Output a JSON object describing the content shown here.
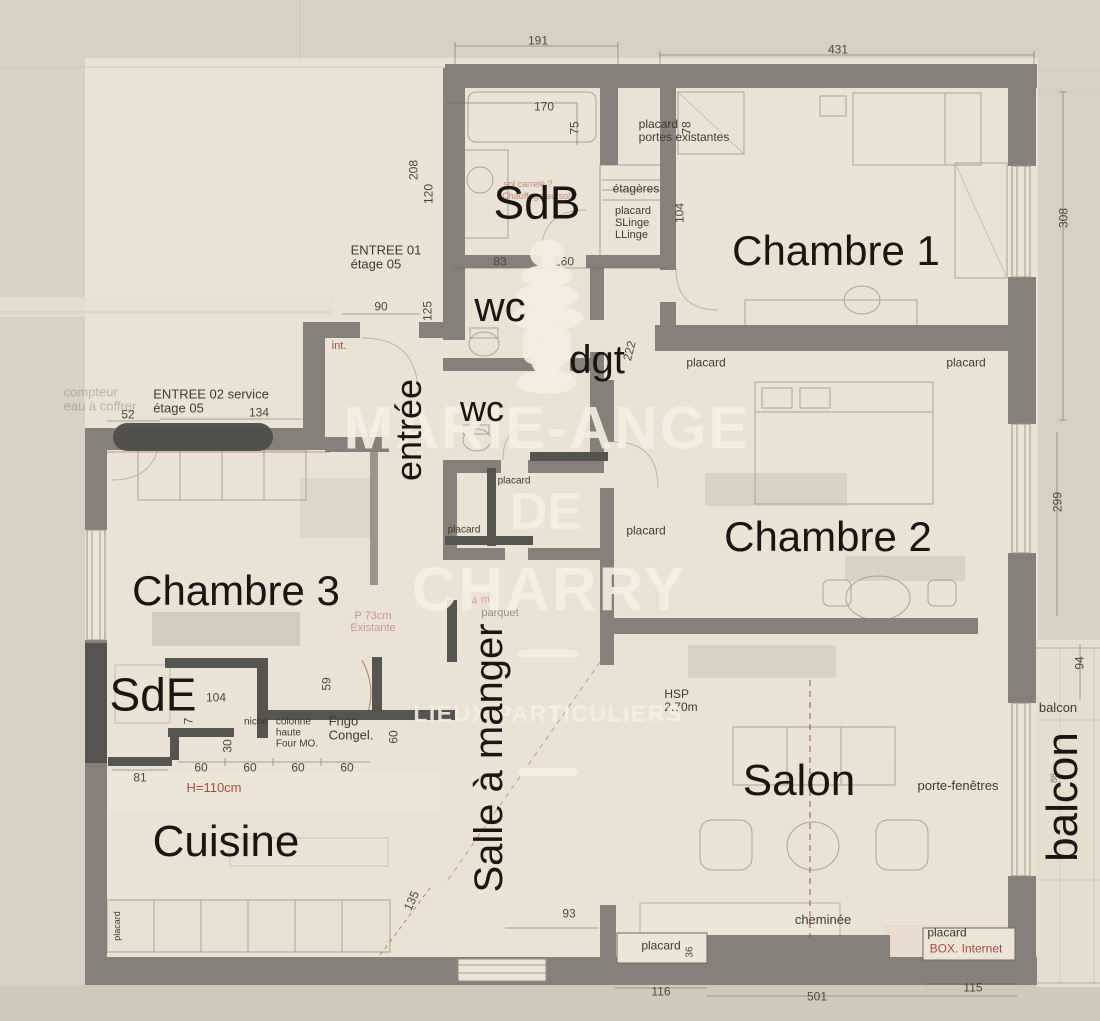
{
  "plan": {
    "background": "#d8d0c3",
    "paper": "#eae3d5",
    "wall_color": "#85817a",
    "marker_color": "#55544f",
    "accent_red": "#a84b3e",
    "watermark_color": "#f2ecdd"
  },
  "watermark": {
    "name": "MARIE-ANGE",
    "de": "DE",
    "surname": "CHARRY",
    "tagline": "LIEUX PARTICULIERS"
  },
  "labels": {
    "rooms": [
      {
        "n": "room-label-sdb",
        "t": "SdB",
        "x": 537,
        "y": 203,
        "s": 46
      },
      {
        "n": "room-label-chambre-1",
        "t": "Chambre 1",
        "x": 836,
        "y": 251,
        "s": 42
      },
      {
        "n": "room-label-chambre-2",
        "t": "Chambre 2",
        "x": 828,
        "y": 537,
        "s": 42
      },
      {
        "n": "room-label-chambre-3",
        "t": "Chambre 3",
        "x": 236,
        "y": 591,
        "s": 42
      },
      {
        "n": "room-label-sde",
        "t": "SdE",
        "x": 153,
        "y": 695,
        "s": 46
      },
      {
        "n": "room-label-cuisine",
        "t": "Cuisine",
        "x": 226,
        "y": 842,
        "s": 44
      },
      {
        "n": "room-label-salon",
        "t": "Salon",
        "x": 799,
        "y": 781,
        "s": 44
      },
      {
        "n": "room-label-wc-1",
        "t": "wc",
        "x": 500,
        "y": 307,
        "s": 42
      },
      {
        "n": "room-label-wc-2",
        "t": "wc",
        "x": 482,
        "y": 409,
        "s": 36
      },
      {
        "n": "room-label-dgt",
        "t": "dgt",
        "x": 597,
        "y": 360,
        "s": 40
      },
      {
        "n": "room-label-entree",
        "t": "entrée",
        "x": 409,
        "y": 430,
        "s": 36,
        "r": -90
      },
      {
        "n": "room-label-salle-a-manger",
        "t": "Salle à manger",
        "x": 489,
        "y": 758,
        "s": 40,
        "r": -90
      },
      {
        "n": "room-label-balcon",
        "t": "balcon",
        "x": 1063,
        "y": 797,
        "s": 44,
        "r": -90
      }
    ],
    "features": [
      {
        "n": "label-placard-portes-existantes",
        "t": "placard\nportes existantes",
        "x": 684,
        "y": 131,
        "s": 12,
        "a": "left"
      },
      {
        "n": "label-etageres",
        "t": "étagères",
        "x": 636,
        "y": 189,
        "s": 12
      },
      {
        "n": "label-placard-slinge-llinge",
        "t": "placard\nSLinge\nLLinge",
        "x": 633,
        "y": 223,
        "s": 11,
        "a": "left"
      },
      {
        "n": "label-entree-01",
        "t": "ENTREE 01\nétage 05",
        "x": 386,
        "y": 258,
        "s": 13,
        "a": "left"
      },
      {
        "n": "label-entree-02-service",
        "t": "ENTREE 02 service\nétage 05",
        "x": 211,
        "y": 402,
        "s": 13,
        "a": "left"
      },
      {
        "n": "label-placard-ch1-left",
        "t": "placard",
        "x": 706,
        "y": 363,
        "s": 12
      },
      {
        "n": "label-placard-ch1-right",
        "t": "placard",
        "x": 966,
        "y": 363,
        "s": 12
      },
      {
        "n": "label-placard-ch2",
        "t": "placard",
        "x": 646,
        "y": 531,
        "s": 12
      },
      {
        "n": "label-placard-couloir-1",
        "t": "placard",
        "x": 514,
        "y": 481,
        "s": 10
      },
      {
        "n": "label-placard-couloir-2",
        "t": "placard",
        "x": 464,
        "y": 530,
        "s": 10
      },
      {
        "n": "label-niche",
        "t": "niche",
        "x": 256,
        "y": 722,
        "s": 10
      },
      {
        "n": "label-colonne-haute-four-mo",
        "t": "colonne\nhaute\nFour MO.",
        "x": 297,
        "y": 733,
        "s": 10,
        "a": "left"
      },
      {
        "n": "label-frigo-congel",
        "t": "Frigo\nCongel.",
        "x": 351,
        "y": 729,
        "s": 13,
        "a": "left"
      },
      {
        "n": "label-cheminee",
        "t": "cheminée",
        "x": 823,
        "y": 920,
        "s": 13
      },
      {
        "n": "label-placard-salon-left",
        "t": "placard",
        "x": 661,
        "y": 946,
        "s": 12
      },
      {
        "n": "label-placard-salon-right",
        "t": "placard",
        "x": 947,
        "y": 933,
        "s": 12
      },
      {
        "n": "label-porte-fenetres",
        "t": "porte-fenêtres",
        "x": 958,
        "y": 786,
        "s": 13
      },
      {
        "n": "label-hsp",
        "t": "HSP\n2.70m",
        "x": 681,
        "y": 701,
        "s": 12,
        "a": "left"
      },
      {
        "n": "label-balcon-small",
        "t": "balcon",
        "x": 1058,
        "y": 708,
        "s": 13
      },
      {
        "n": "label-placard-cuisine",
        "t": "placard",
        "x": 118,
        "y": 926,
        "s": 9,
        "r": -90
      },
      {
        "n": "label-parquet",
        "t": "parquet",
        "x": 500,
        "y": 613,
        "s": 11,
        "o": 0.5
      }
    ],
    "dimensions": [
      {
        "n": "dim-191",
        "t": "191",
        "x": 538,
        "y": 41
      },
      {
        "n": "dim-431",
        "t": "431",
        "x": 838,
        "y": 50
      },
      {
        "n": "dim-170",
        "t": "170",
        "x": 544,
        "y": 107
      },
      {
        "n": "dim-75",
        "t": "75",
        "x": 575,
        "y": 128,
        "r": -90
      },
      {
        "n": "dim-208",
        "t": "208",
        "x": 414,
        "y": 170,
        "r": -90
      },
      {
        "n": "dim-120",
        "t": "120",
        "x": 429,
        "y": 194,
        "r": -90
      },
      {
        "n": "dim-78",
        "t": "78",
        "x": 687,
        "y": 128,
        "r": -90
      },
      {
        "n": "dim-104-placard",
        "t": "104",
        "x": 680,
        "y": 213,
        "r": -90
      },
      {
        "n": "dim-308",
        "t": "308",
        "x": 1064,
        "y": 218,
        "r": -90
      },
      {
        "n": "dim-83",
        "t": "83",
        "x": 500,
        "y": 262
      },
      {
        "n": "dim-160",
        "t": "160",
        "x": 564,
        "y": 262
      },
      {
        "n": "dim-90",
        "t": "90",
        "x": 381,
        "y": 307
      },
      {
        "n": "dim-125",
        "t": "125",
        "x": 428,
        "y": 311,
        "r": -90
      },
      {
        "n": "dim-222",
        "t": "222",
        "x": 630,
        "y": 351,
        "r": -75
      },
      {
        "n": "dim-52",
        "t": "52",
        "x": 128,
        "y": 415
      },
      {
        "n": "dim-134",
        "t": "134",
        "x": 259,
        "y": 413
      },
      {
        "n": "dim-299",
        "t": "299",
        "x": 1058,
        "y": 502,
        "r": -90
      },
      {
        "n": "dim-104-sde",
        "t": "104",
        "x": 216,
        "y": 698
      },
      {
        "n": "dim-59",
        "t": "59",
        "x": 327,
        "y": 684,
        "r": -90
      },
      {
        "n": "dim-7",
        "t": "7",
        "x": 189,
        "y": 721,
        "r": -90
      },
      {
        "n": "dim-30",
        "t": "30",
        "x": 228,
        "y": 746,
        "r": -90
      },
      {
        "n": "dim-60-1",
        "t": "60",
        "x": 201,
        "y": 768
      },
      {
        "n": "dim-60-2",
        "t": "60",
        "x": 250,
        "y": 768
      },
      {
        "n": "dim-60-3",
        "t": "60",
        "x": 298,
        "y": 768
      },
      {
        "n": "dim-60-4",
        "t": "60",
        "x": 347,
        "y": 768
      },
      {
        "n": "dim-60-5",
        "t": "60",
        "x": 394,
        "y": 737,
        "r": -90
      },
      {
        "n": "dim-81",
        "t": "81",
        "x": 140,
        "y": 778
      },
      {
        "n": "dim-94",
        "t": "94",
        "x": 1080,
        "y": 663,
        "r": -90
      },
      {
        "n": "dim-88",
        "t": "88",
        "x": 1055,
        "y": 778,
        "r": -90,
        "s": 9,
        "o": 0.7
      },
      {
        "n": "dim-135",
        "t": "135",
        "x": 412,
        "y": 901,
        "r": -65
      },
      {
        "n": "dim-93",
        "t": "93",
        "x": 569,
        "y": 914
      },
      {
        "n": "dim-36",
        "t": "36",
        "x": 690,
        "y": 952,
        "r": -90,
        "s": 10
      },
      {
        "n": "dim-116",
        "t": "116",
        "x": 661,
        "y": 992
      },
      {
        "n": "dim-501",
        "t": "501",
        "x": 817,
        "y": 997
      },
      {
        "n": "dim-115",
        "t": "115",
        "x": 973,
        "y": 988
      }
    ],
    "red_notes": [
      {
        "n": "note-h110",
        "t": "H=110cm",
        "x": 214,
        "y": 788,
        "s": 13
      },
      {
        "n": "note-box-internet",
        "t": "BOX. Internet",
        "x": 966,
        "y": 949,
        "s": 12
      },
      {
        "n": "note-int",
        "t": "int.",
        "x": 339,
        "y": 346,
        "s": 11
      },
      {
        "n": "note-q",
        "t": "Q ?",
        "x": 546,
        "y": 348,
        "s": 10,
        "o": 0.7
      },
      {
        "n": "note-sol-carrele",
        "t": "sol carrelé ?",
        "x": 528,
        "y": 185,
        "s": 9,
        "o": 0.6
      },
      {
        "n": "note-chauffage-sol",
        "t": "Chauffage au sol ?",
        "x": 540,
        "y": 197,
        "s": 9,
        "o": 0.6
      },
      {
        "n": "note-p73",
        "t": "P 73cm\nExistante",
        "x": 373,
        "y": 622,
        "s": 11,
        "o": 0.5
      },
      {
        "n": "note-54m2",
        "t": "5,4 m²",
        "x": 478,
        "y": 601,
        "s": 11,
        "o": 0.4,
        "r": -8
      }
    ],
    "faded": [
      {
        "n": "note-compteur-eau",
        "t": "compteur\neau à coffrer",
        "x": 100,
        "y": 400,
        "s": 13,
        "a": "left"
      }
    ]
  }
}
